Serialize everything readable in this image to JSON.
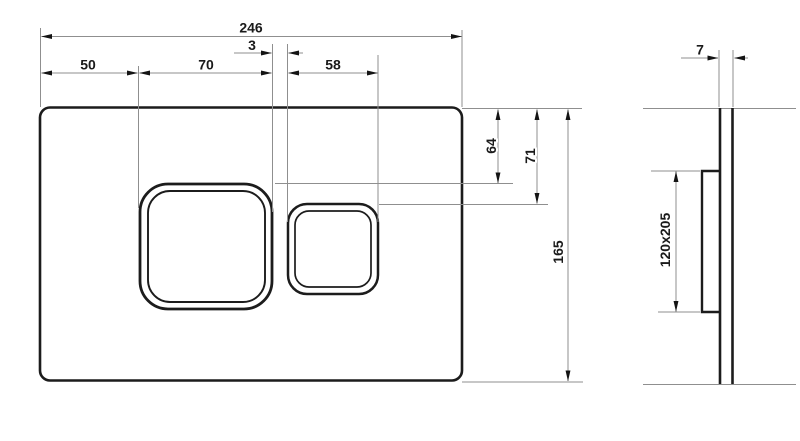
{
  "drawing": {
    "front_view": {
      "dim_total_width": "246",
      "dim_left_offset": "50",
      "dim_large_button_width": "70",
      "dim_button_gap": "3",
      "dim_small_button_width": "58",
      "dim_large_button_top_offset": "64",
      "dim_small_button_top_offset": "71",
      "dim_total_height": "165"
    },
    "side_view": {
      "dim_plate_thickness": "7",
      "dim_frame_size": "120x205"
    },
    "colors": {
      "background": "#ffffff",
      "part_outline": "#1c1c1c",
      "dimension_line": "#8f8f8f",
      "arrowhead": "#141414",
      "label_text": "#1a1a1a"
    }
  }
}
